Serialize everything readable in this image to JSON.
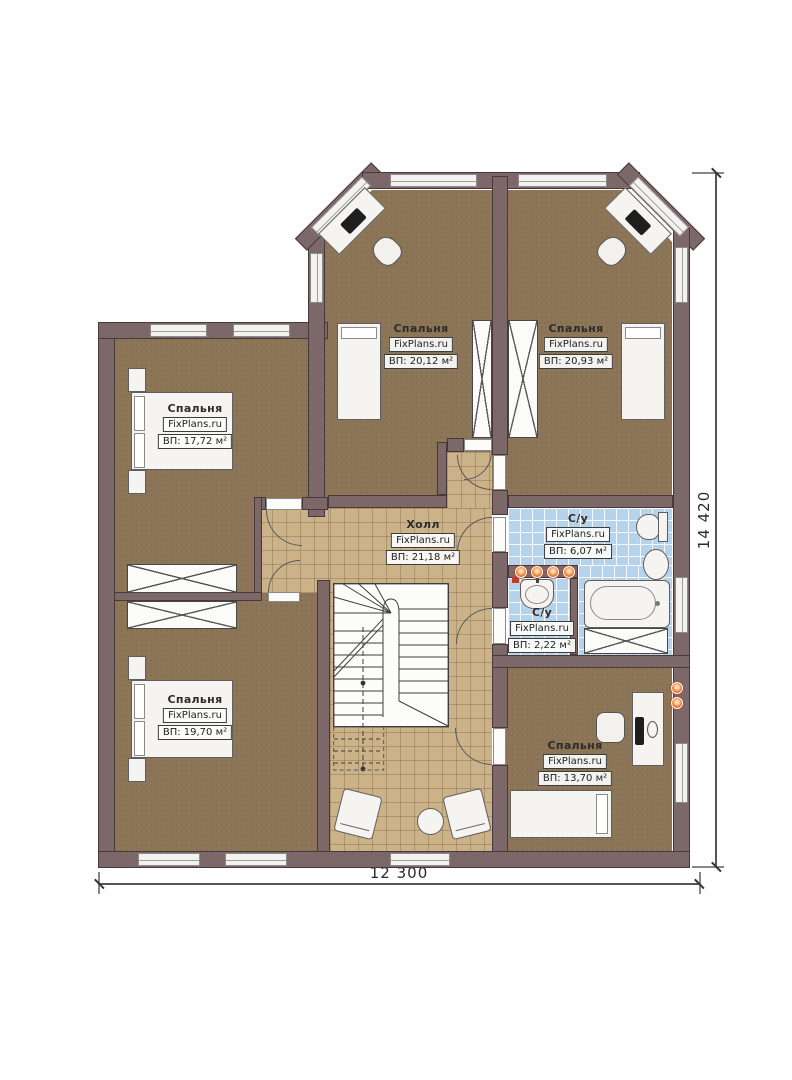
{
  "watermark": "FixPlans.ru",
  "dims": {
    "width": "12 300",
    "height": "14 420"
  },
  "rooms": [
    {
      "id": "bedroom-left",
      "name": "Спальня",
      "area": "ВП: 17,72 м²"
    },
    {
      "id": "bedroom-top-middle",
      "name": "Спальня",
      "area": "ВП: 20,12 м²"
    },
    {
      "id": "bedroom-top-right",
      "name": "Спальня",
      "area": "ВП: 20,93 м²"
    },
    {
      "id": "hall",
      "name": "Холл",
      "area": "ВП: 21,18 м²"
    },
    {
      "id": "bathroom-main",
      "name": "С/у",
      "area": "ВП: 6,07 м²"
    },
    {
      "id": "bathroom-small",
      "name": "С/у",
      "area": "ВП: 2,22 м²"
    },
    {
      "id": "bedroom-bottom-left",
      "name": "Спальня",
      "area": "ВП: 19,70 м²"
    },
    {
      "id": "bedroom-bottom-right",
      "name": "Спальня",
      "area": "ВП: 13,70 м²"
    }
  ],
  "colors": {
    "wall": "#7d6869",
    "bedroom_floor": "#8d7557",
    "hall_floor": "#cbb289",
    "bathroom_floor": "#b5d3ea",
    "spot_light": "#e8762e"
  }
}
